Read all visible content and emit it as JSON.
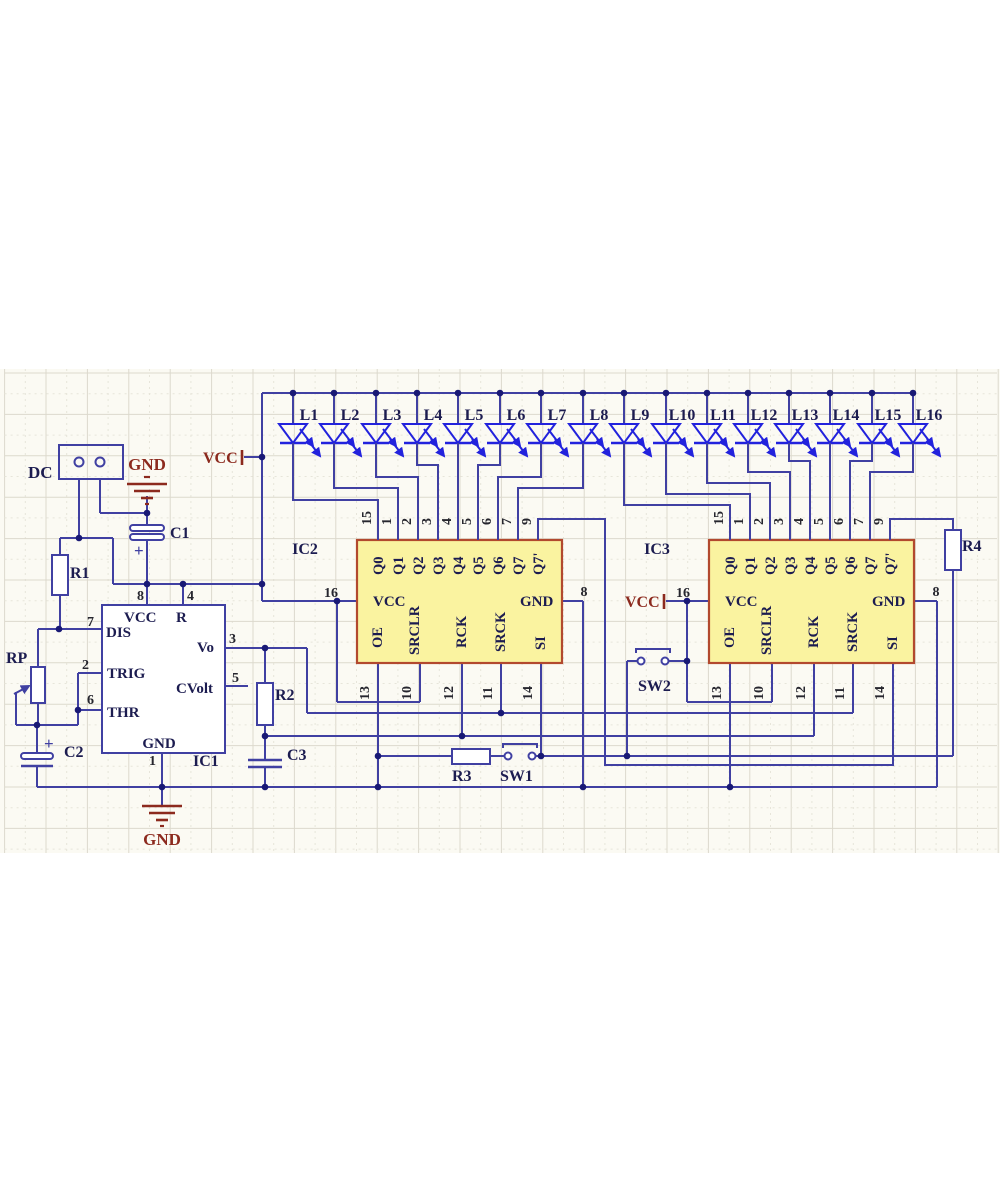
{
  "title": "555 timer with two 74HC595 shift registers driving 16 LEDs",
  "colors": {
    "background": "#fbfaf3",
    "grid_major": "#dcd9cd",
    "grid_minor": "#e7e5da",
    "wire": "#4040a2",
    "led_blue": "#2222dd",
    "chip_fill": "#faf3a0",
    "chip_border": "#b2492e",
    "component_text": "#1c1c50",
    "pin_number_text": "#26262e",
    "power_red": "#8c2a1e",
    "junction_dot": "#191975",
    "component_fill": "#ffffff"
  },
  "connector": {
    "label": "DC"
  },
  "power": {
    "vcc": "VCC",
    "gnd": "GND"
  },
  "leds": [
    "L1",
    "L2",
    "L3",
    "L4",
    "L5",
    "L6",
    "L7",
    "L8",
    "L9",
    "L10",
    "L11",
    "L12",
    "L13",
    "L14",
    "L15",
    "L16"
  ],
  "refs": {
    "ic1": "IC1",
    "ic2": "IC2",
    "ic3": "IC3",
    "r1": "R1",
    "r2": "R2",
    "r3": "R3",
    "r4": "R4",
    "rp": "RP",
    "c1": "C1",
    "c2": "C2",
    "c3": "C3",
    "sw1": "SW1",
    "sw2": "SW2"
  },
  "ic555": {
    "top": [
      {
        "num": "8",
        "label": "VCC"
      },
      {
        "num": "4",
        "label": "R"
      }
    ],
    "left": [
      {
        "num": "7",
        "label": "DIS"
      },
      {
        "num": "2",
        "label": "TRIG"
      },
      {
        "num": "6",
        "label": "THR"
      }
    ],
    "right": [
      {
        "num": "3",
        "label": "Vo"
      },
      {
        "num": "5",
        "label": "CVolt"
      }
    ],
    "bottom": [
      {
        "num": "1",
        "label": "GND"
      }
    ]
  },
  "shift_register": {
    "outputs": [
      "Q0",
      "Q1",
      "Q2",
      "Q3",
      "Q4",
      "Q5",
      "Q6",
      "Q7",
      "Q7'"
    ],
    "output_pins": [
      "15",
      "1",
      "2",
      "3",
      "4",
      "5",
      "6",
      "7",
      "9"
    ],
    "control_labels": [
      "OE",
      "SRCLR",
      "RCK",
      "SRCK",
      "SI"
    ],
    "control_pins": [
      "13",
      "10",
      "12",
      "11",
      "14"
    ],
    "vcc_label": "VCC",
    "vcc_pin": "16",
    "gnd_label": "GND",
    "gnd_pin": "8"
  }
}
